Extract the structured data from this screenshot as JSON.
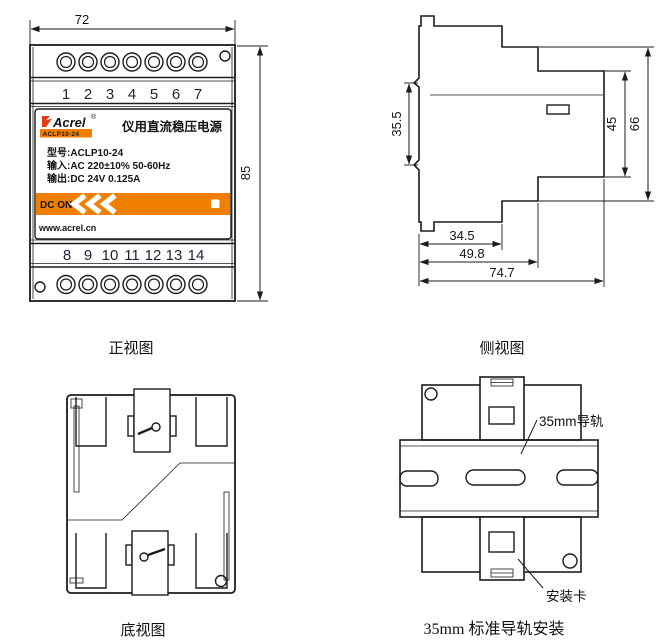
{
  "colors": {
    "orange": "#F07F00",
    "brand_red": "#E8380D",
    "ink": "#141414"
  },
  "front": {
    "caption": "正视图",
    "dim_width": "72",
    "dim_height": "85",
    "terminals_top": [
      "1",
      "2",
      "3",
      "4",
      "5",
      "6",
      "7"
    ],
    "terminals_bottom": [
      "8",
      "9",
      "10",
      "11",
      "12",
      "13",
      "14"
    ],
    "label": {
      "brand": "Acrel",
      "registered": "®",
      "model_badge": "ACLP10-24",
      "product_title": "仪用直流稳压电源",
      "spec_model": "型号:ACLP10-24",
      "spec_input": "输入:AC 220±10% 50-60Hz",
      "spec_output": "输出:DC 24V 0.125A",
      "dc_on": "DC ON",
      "website": "www.acrel.cn"
    }
  },
  "side": {
    "caption": "侧视图",
    "dim_clip": "35.5",
    "dim_body_height": "45",
    "dim_total_height": "66",
    "dim_depth1": "34.5",
    "dim_depth2": "49.8",
    "dim_depth3": "74.7"
  },
  "bottom": {
    "caption": "底视图"
  },
  "rail": {
    "caption": "35mm 标准导轨安装",
    "rail_label": "35mm导轨",
    "clip_label": "安装卡"
  }
}
